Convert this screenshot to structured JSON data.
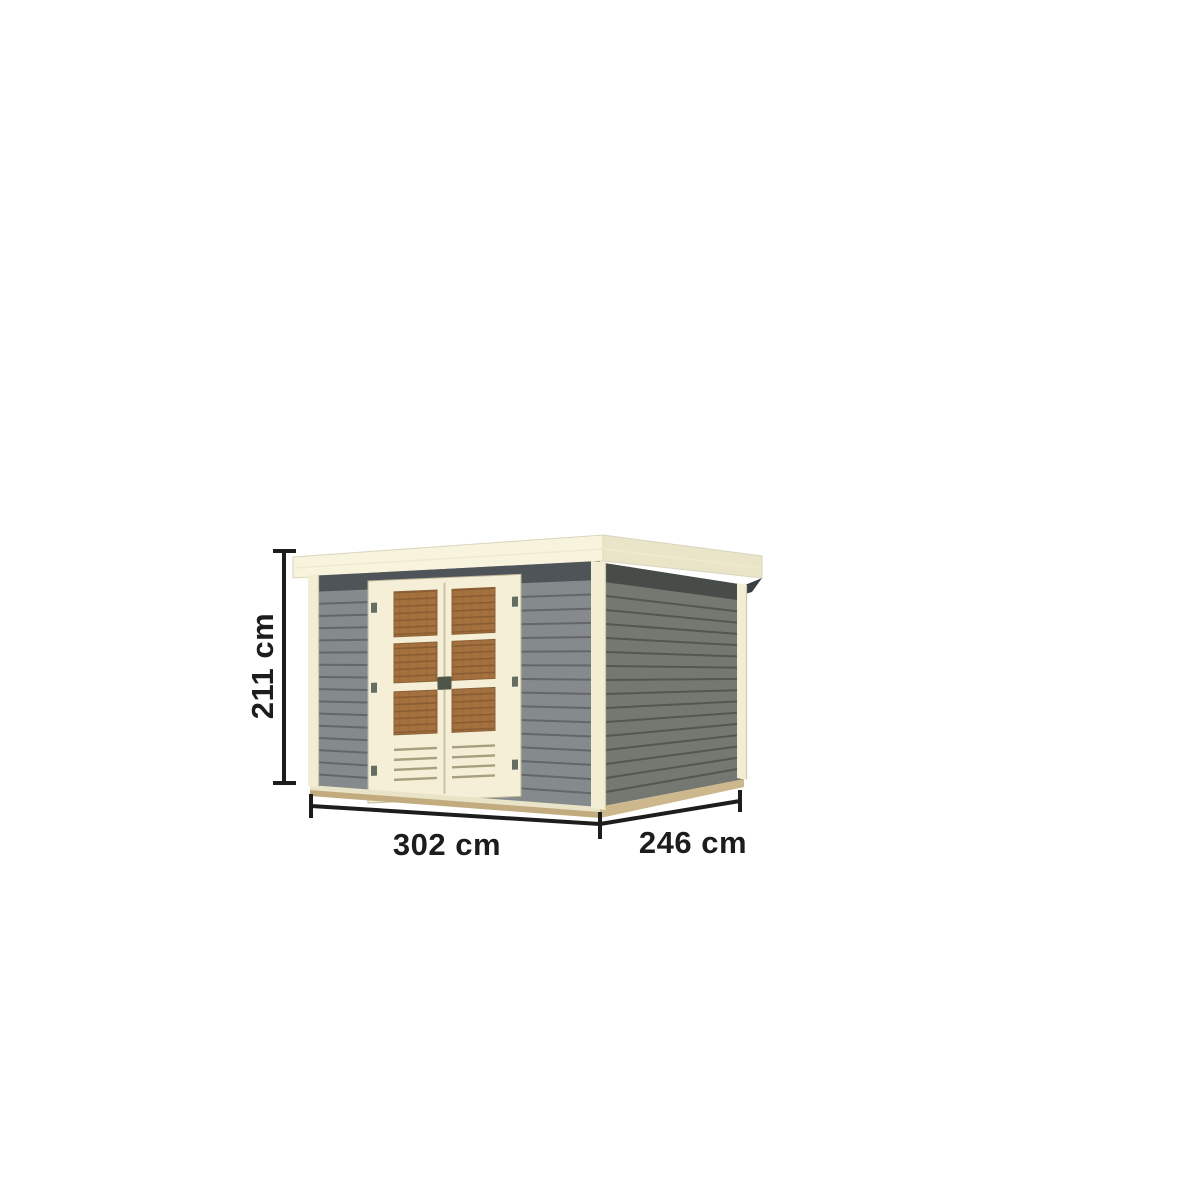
{
  "diagram": {
    "subject": "flat-roof garden shed with double door, 3d product view with measurements",
    "dimension_labels": {
      "height": "211 cm",
      "width": "302 cm",
      "depth": "246 cm"
    },
    "colors": {
      "background": "#ffffff",
      "dimension_ink": "#1d1d1b",
      "roof_front": "#f7f3dc",
      "roof_side": "#eae4c8",
      "wall_front": "#858a8d",
      "wall_front_groove": "#63676a",
      "wall_side": "#747871",
      "wall_side_groove": "#53574f",
      "shadow_band_front": "#4f5458",
      "shadow_band_side": "#474c49",
      "trim_cream": "#f2edd3",
      "door_cream": "#f4efd6",
      "window_brown": "#a5713f",
      "window_brown_dark": "#8a5c31",
      "base_tan": "#c3ab80",
      "handle": "#4e5747"
    }
  }
}
